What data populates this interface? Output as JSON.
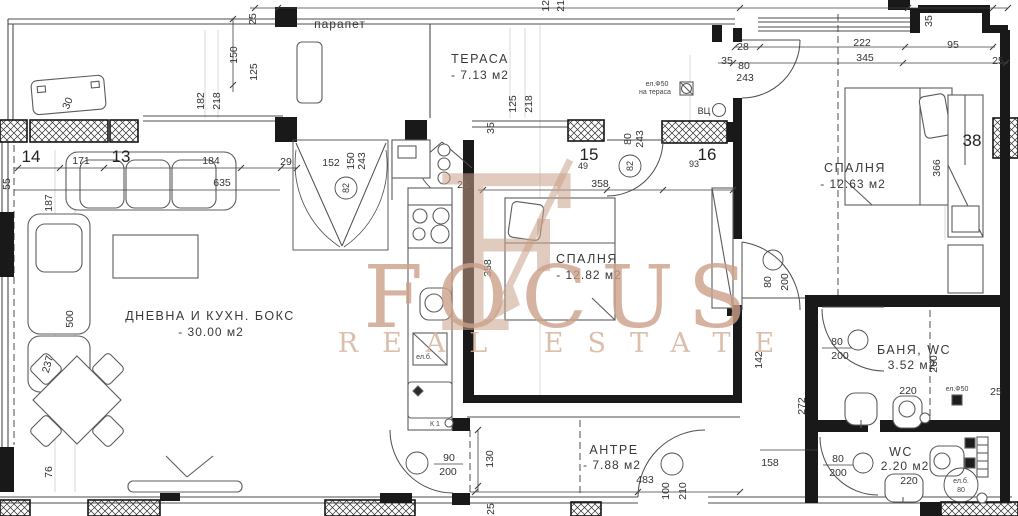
{
  "watermark": {
    "brand": "FOCUS",
    "tagline": "REAL ESTATE",
    "monogram": "F",
    "color": "#c9a189"
  },
  "rooms": {
    "terrace": {
      "name": "ТЕРАСА",
      "area": "- 7.13 м2"
    },
    "bedroom_right": {
      "name": "СПАЛНЯ",
      "area": "- 12.63 м2"
    },
    "bedroom_mid": {
      "name": "СПАЛНЯ",
      "area": "- 12.82 м2"
    },
    "living": {
      "name": "ДНЕВНА И КУХН. БОКС",
      "area": "- 30.00 м2"
    },
    "hall": {
      "name": "АНТРЕ",
      "area": "- 7.88 м2"
    },
    "bath": {
      "name": "БАНЯ, WC",
      "area": "3.52 м2"
    },
    "wc": {
      "name": "WC",
      "area": "2.20 м2"
    }
  },
  "axes": {
    "a13": "13",
    "a14": "14",
    "a15": "15",
    "a16": "16"
  },
  "dims": {
    "d25": "25",
    "d28": "28",
    "d29": "29",
    "d30": "30",
    "d35": "35",
    "d38": "38",
    "d49": "49",
    "d55": "55",
    "d76": "76",
    "d80": "80",
    "d82": "82",
    "d90": "90",
    "d93": "93",
    "d95": "95",
    "d100": "100",
    "d125": "125",
    "d130": "130",
    "d142": "142",
    "d150": "150",
    "d152": "152",
    "d158": "158",
    "d171": "171",
    "d182": "182",
    "d184": "184",
    "d187": "187",
    "d200": "200",
    "d210": "210",
    "d218": "218",
    "d220": "220",
    "d222": "222",
    "d237": "237",
    "d243": "243",
    "d260": "260",
    "d272": "272",
    "d345": "345",
    "d358": "358",
    "d366": "366",
    "d483": "483",
    "d500": "500",
    "d635": "635"
  },
  "notes": {
    "parapet": "парапет",
    "el_f50": "ел.Ф50",
    "on_terrace": "на тераса",
    "vc": "ВЦ",
    "k1": "К 1",
    "el_b": "ел.б.",
    "el_b_80": "80"
  }
}
